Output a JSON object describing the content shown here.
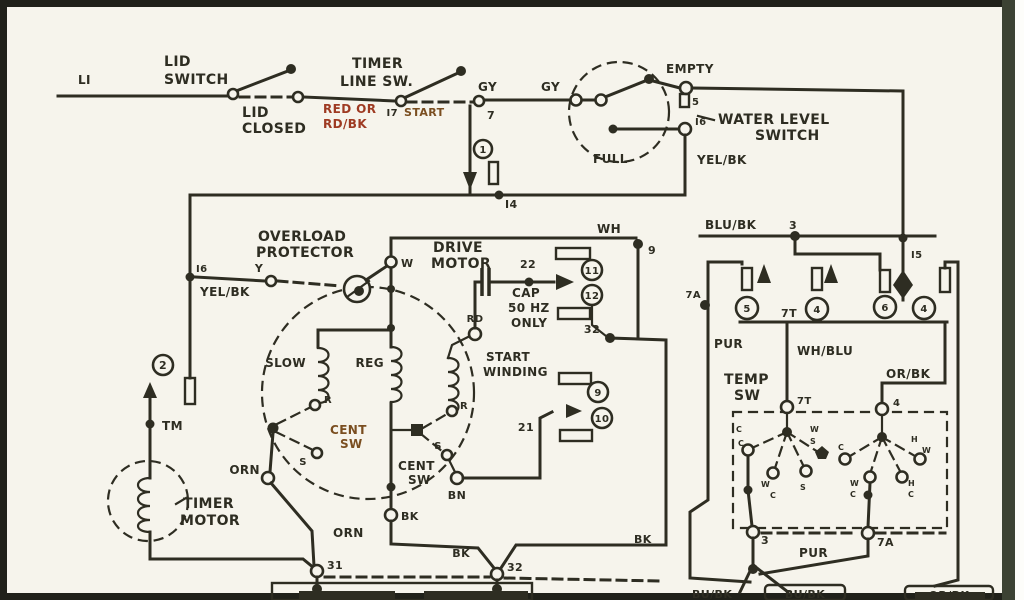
{
  "diagram": {
    "kind": "scanned washing machine wiring schematic",
    "colors": {
      "ink": "#2e2d22",
      "paper": "#f6f4ec",
      "red_wire_text": "#9e3a22",
      "brown_text": "#7a4e20",
      "scan_bar": "#3c4233"
    },
    "labels": {
      "li": "LI",
      "lid_switch_1": "LID",
      "lid_switch_2": "SWITCH",
      "lid_closed_1": "LID",
      "lid_closed_2": "CLOSED",
      "red_or": "RED OR",
      "rd_bk": "RD/BK",
      "timer_line_1": "TIMER",
      "timer_line_2": "LINE SW.",
      "i7": "I7",
      "start": "START",
      "n7": "7",
      "gy1": "GY",
      "gy2": "GY",
      "empty": "EMPTY",
      "n5": "5",
      "i6_wls": "I6",
      "full": "FULL",
      "water_level_1": "WATER LEVEL",
      "water_level_2": "SWITCH",
      "yel_bk_right": "YEL/BK",
      "c1_num": "1",
      "i4": "I4",
      "i6_left": "I6",
      "yel_bk_left": "YEL/BK",
      "c2_num": "2",
      "tm": "TM",
      "overload_1": "OVERLOAD",
      "overload_2": "PROTECTOR",
      "y": "Y",
      "w": "W",
      "drive_1": "DRIVE",
      "drive_2": "MOTOR",
      "n22": "22",
      "cap_1": "CAP",
      "cap_2": "50 HZ",
      "cap_3": "ONLY",
      "rd": "RD",
      "slow": "SLOW",
      "reg": "REG",
      "start_winding_1": "START",
      "start_winding_2": "WINDING",
      "wh": "WH",
      "n9": "9",
      "t11": "11",
      "t12": "12",
      "n32_mid": "32",
      "t9": "9",
      "t10": "10",
      "n21": "21",
      "cent1_1": "CENT",
      "cent1_2": "SW",
      "r1": "R",
      "s1": "S",
      "orn1": "ORN",
      "orn2": "ORN",
      "cent2_1": "CENT",
      "cent2_2": "SW",
      "r2": "R",
      "s2": "S",
      "bn": "BN",
      "bk1": "BK",
      "timer_motor_1": "TIMER",
      "timer_motor_2": "MOTOR",
      "n31": "31",
      "n32": "32",
      "bk2": "BK",
      "bk3": "BK",
      "blu_bk": "BLU/BK",
      "n3_top": "3",
      "i5": "I5",
      "n7a_top": "7A",
      "pur1": "PUR",
      "n7t_row": "7T",
      "t_c1": "5",
      "t_c2": "4",
      "t_c3": "6",
      "t_c4": "4",
      "wh_blu": "WH/BLU",
      "temp_1": "TEMP",
      "temp_2": "SW",
      "or_bk": "OR/BK",
      "n7t_hub": "7T",
      "n4_hub": "4",
      "n3_bot": "3",
      "n7a_bot": "7A",
      "pur2": "PUR",
      "bu_bk_1": "BU/BK",
      "bu_bk_2": "BU/BK",
      "or_bk_bot": "OR/BK"
    },
    "temp_sw": {
      "contacts_left": [
        "C",
        "C",
        "W",
        "S",
        "W",
        "C",
        "S"
      ],
      "contacts_right": [
        "C",
        "H",
        "W",
        "W",
        "C",
        "H",
        "C"
      ]
    }
  }
}
